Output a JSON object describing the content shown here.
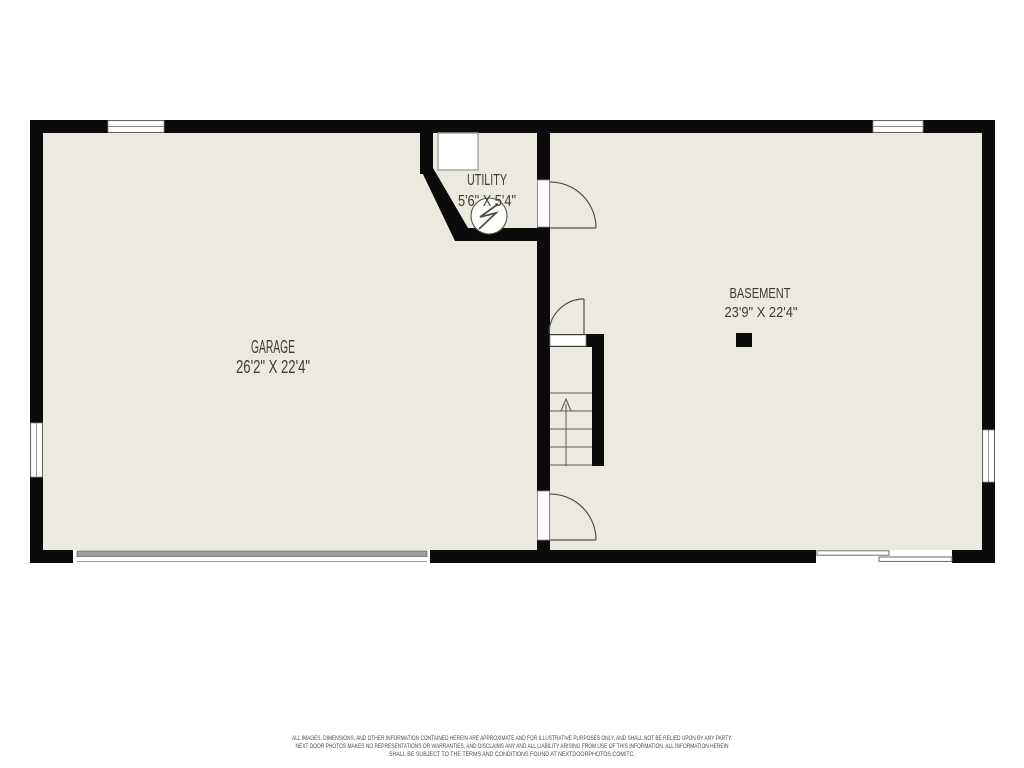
{
  "floorplan": {
    "rooms": [
      {
        "name": "GARAGE",
        "dimensions": "26'2\" X 22'4\""
      },
      {
        "name": "UTILITY",
        "dimensions": "5'6\" X 5'4\""
      },
      {
        "name": "BASEMENT",
        "dimensions": "23'9\" X 22'4\""
      }
    ],
    "symbols": [
      "garage-door",
      "sliding-glass-door",
      "window",
      "door-swing",
      "stairs-up-arrow",
      "water-heater",
      "furnace",
      "support-column"
    ],
    "colors": {
      "wall": "#0b0b0b",
      "floor": "#eceae0",
      "label_text": "#3e3b35",
      "symbol_line": "#4f4f4b",
      "garage_door_fill": "#9e9e9e",
      "background": "#ffffff"
    }
  },
  "disclaimer": {
    "lines": [
      "ALL IMAGES, DIMENSIONS, AND OTHER INFORMATION CONTAINED HEREIN ARE APPROXIMATE AND FOR ILLUSTRATIVE PURPOSES ONLY, AND SHALL NOT BE RELIED UPON BY ANY PARTY.",
      "NEXT DOOR PHOTOS MAKES NO REPRESENTATIONS OR WARRANTIES, AND DISCLAIMS ANY AND ALL LIABILITY ARISING FROM USE OF THIS INFORMATION. ALL INFORMATION HEREIN",
      "SHALL BE SUBJECT TO THE TERMS AND CONDITIONS FOUND AT NEXTDOORPHOTOS.COM/TC."
    ]
  }
}
